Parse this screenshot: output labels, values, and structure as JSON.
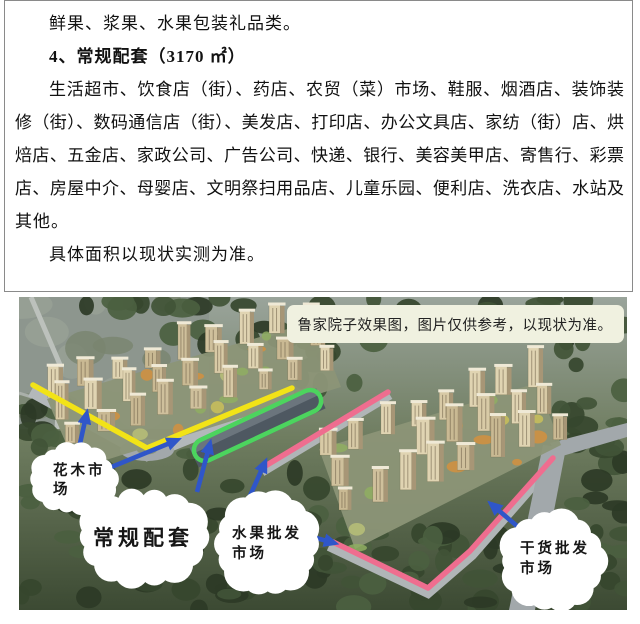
{
  "doc": {
    "intro": "鲜果、浆果、水果包装礼品类。",
    "heading": "4、常规配套（3170 ㎡）",
    "body_lines": [
      "生活超市、饮食店（街）、药店、农贸（菜）市场、鞋服、烟酒店、装饰装",
      "修（街）、数码通信店（街）、美发店、打印店、办公文具店、家纺（街）店、烘",
      "焙店、五金店、家政公司、广告公司、快递、银行、美容美甲店、寄售行、彩票",
      "店、房屋中介、母婴店、文明祭扫用品店、儿童乐园、便利店、洗衣店、水站及",
      "其他。"
    ],
    "note": "具体面积以现状实测为准。"
  },
  "photo": {
    "caption": "鲁家院子效果图，图片仅供参考，以现状为准。",
    "callouts": {
      "huamu": {
        "line1": "花木市",
        "line2": "场"
      },
      "changgui": {
        "line1": "常规配套"
      },
      "shuiguo": {
        "line1": "水果批发",
        "line2": "市场"
      },
      "ganhuo": {
        "line1": "干货批发",
        "line2": "市场"
      }
    },
    "colors": {
      "yellow": "#f2e317",
      "green": "#4cd45e",
      "pink": "#ef6d8f",
      "blue": "#2f56c9",
      "caption_bg": "#f0f1e0"
    }
  }
}
